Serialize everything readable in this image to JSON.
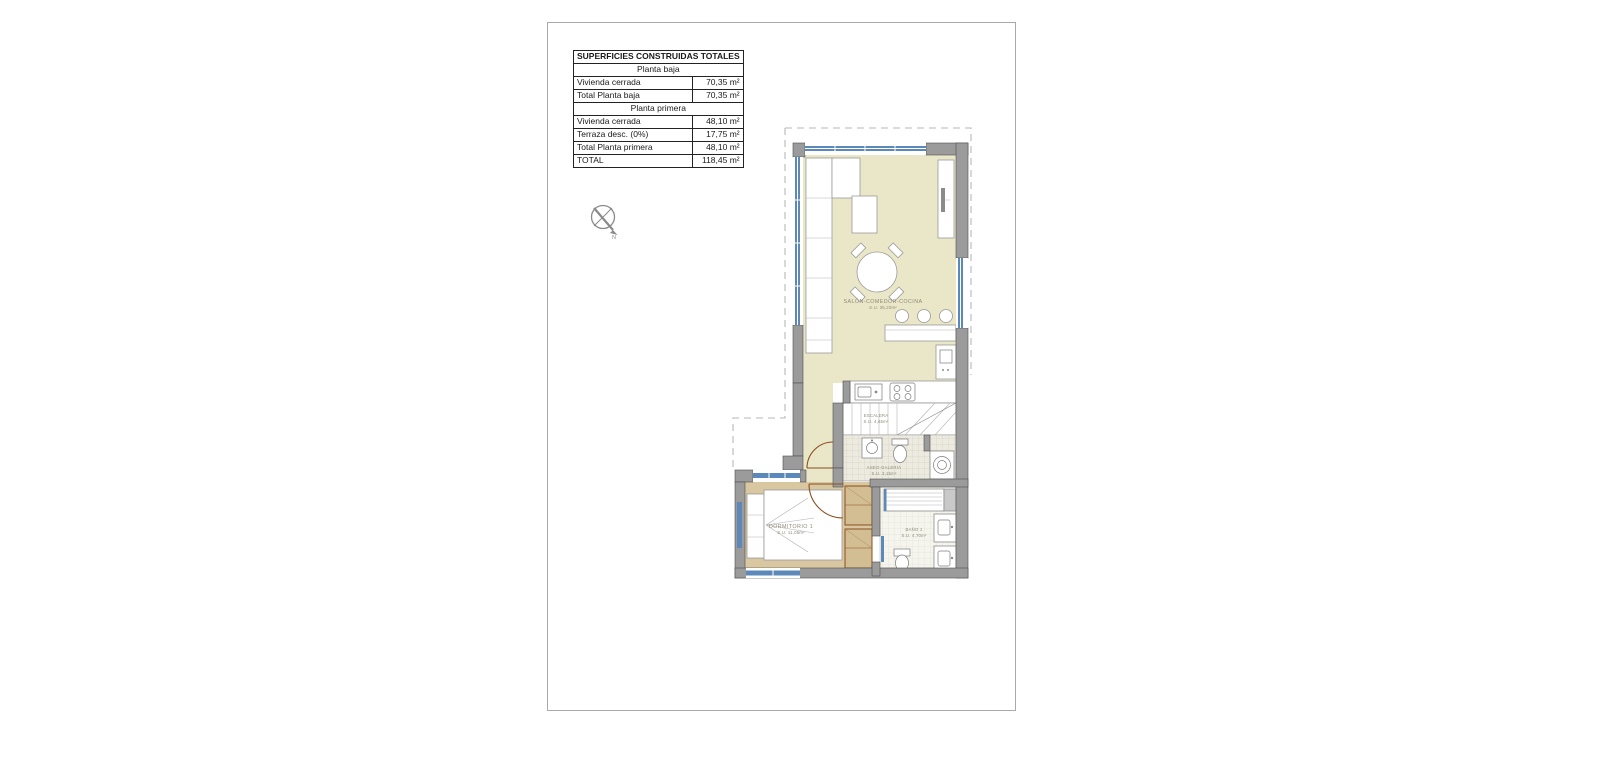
{
  "table": {
    "rows": [
      {
        "label": "SUPERFICIES CONSTRUIDAS TOTALES",
        "value": ""
      },
      {
        "label": "Planta baja",
        "value": ""
      },
      {
        "label": "Vivienda cerrada",
        "value": "70,35 m²"
      },
      {
        "label": "Total Planta baja",
        "value": "70,35 m²"
      },
      {
        "label": "Planta primera",
        "value": ""
      },
      {
        "label": "Vivienda cerrada",
        "value": "48,10 m²"
      },
      {
        "label": "Terraza desc. (0%)",
        "value": "17,75 m²"
      },
      {
        "label": "Total Planta primera",
        "value": "48,10 m²"
      },
      {
        "label": "TOTAL",
        "value": "118,45 m²"
      }
    ]
  },
  "floorplan": {
    "compass_label": "N",
    "rooms": [
      {
        "name": "SALÓN-COMEDOR-COCINA",
        "area": "S.U. 35,20m²"
      },
      {
        "name": "ESCALERA",
        "area": "S.U. 4,65m²"
      },
      {
        "name": "ASEO-GALERIA",
        "area": "S.U. 3,15m²"
      },
      {
        "name": "DORMITORIO 1",
        "area": "S.U. 11,05m²"
      },
      {
        "name": "BAÑO 1",
        "area": "S.U. 4,70m²"
      }
    ]
  },
  "colors": {
    "wall": "#9b9b9b",
    "window_glass": "#5d89ba",
    "living_floor": "#eae6c8",
    "bedroom_floor": "#d8c7a0",
    "door_wood": "#8b4f1f",
    "label_text": "#8f8c78"
  }
}
